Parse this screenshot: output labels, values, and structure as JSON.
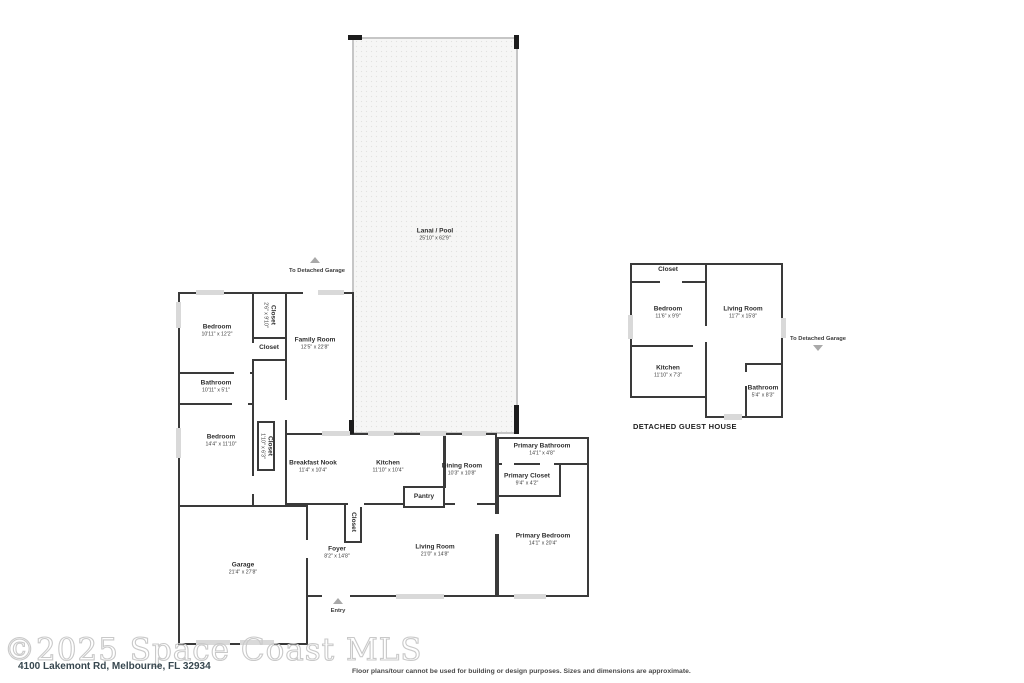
{
  "footer": {
    "watermark": "©2025 Space Coast MLS",
    "address": "4100 Lakemont Rd, Melbourne, FL 32934",
    "disclaimer": "Floor plans/tour cannot be used for building or design purposes. Sizes and dimensions are approximate."
  },
  "main_house": {
    "to_detached_garage": "To Detached Garage",
    "lanai": {
      "name": "Lanai / Pool",
      "dims": "25'10\" x 62'9\""
    },
    "bedroom1": {
      "name": "Bedroom",
      "dims": "10'11\" x 12'2\""
    },
    "closet_hall": {
      "name": "Closet",
      "dims": "2'6\" x 9'10\""
    },
    "closet_small": {
      "name": "Closet"
    },
    "family_room": {
      "name": "Family Room",
      "dims": "12'5\" x 22'8\""
    },
    "bathroom": {
      "name": "Bathroom",
      "dims": "10'11\" x 5'1\""
    },
    "bedroom2": {
      "name": "Bedroom",
      "dims": "14'4\" x 11'10\""
    },
    "closet_bedroom2": {
      "name": "Closet",
      "dims": "1'10\" x 6'3\""
    },
    "breakfast_nook": {
      "name": "Breakfast Nook",
      "dims": "11'4\" x 10'4\""
    },
    "kitchen": {
      "name": "Kitchen",
      "dims": "11'10\" x 10'4\""
    },
    "dining_room": {
      "name": "Dining Room",
      "dims": "10'3\" x 10'8\""
    },
    "pantry": {
      "name": "Pantry"
    },
    "primary_bathroom": {
      "name": "Primary Bathroom",
      "dims": "14'1\" x 4'8\""
    },
    "primary_closet": {
      "name": "Primary Closet",
      "dims": "9'4\" x 4'2\""
    },
    "primary_bedroom": {
      "name": "Primary Bedroom",
      "dims": "14'1\" x 20'4\""
    },
    "closet_foyer": {
      "name": "Closet"
    },
    "foyer": {
      "name": "Foyer",
      "dims": "8'2\" x 14'8\""
    },
    "living_room": {
      "name": "Living Room",
      "dims": "21'0\" x 14'8\""
    },
    "garage": {
      "name": "Garage",
      "dims": "21'4\" x 27'8\""
    },
    "entry": "Entry"
  },
  "guest_house": {
    "title": "DETACHED GUEST HOUSE",
    "to_detached_garage": "To Detached Garage",
    "closet": {
      "name": "Closet"
    },
    "bedroom": {
      "name": "Bedroom",
      "dims": "11'6\" x 9'9\""
    },
    "living_room": {
      "name": "Living Room",
      "dims": "11'7\" x 15'8\""
    },
    "kitchen": {
      "name": "Kitchen",
      "dims": "11'10\" x 7'3\""
    },
    "bathroom": {
      "name": "Bathroom",
      "dims": "5'4\" x 8'3\""
    }
  },
  "colors": {
    "wall": "#3a3a3a",
    "window": "#d9d9d9",
    "lanai_fill": "#f6f6f5",
    "lanai_border": "#c6c6c6"
  }
}
